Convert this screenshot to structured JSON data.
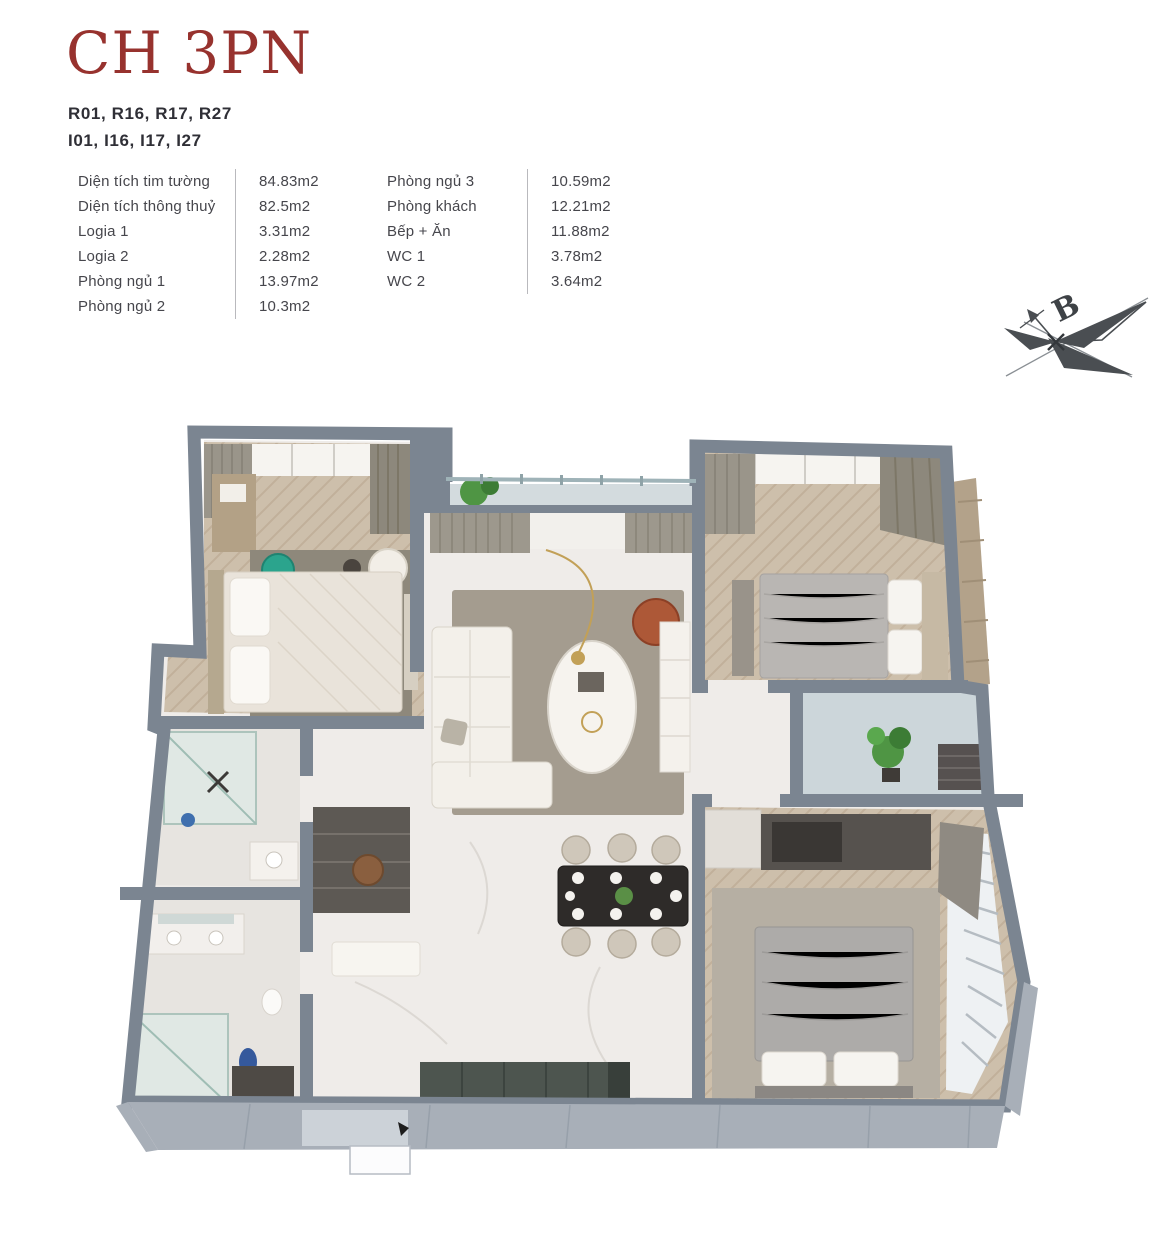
{
  "page": {
    "title": "CH 3PN"
  },
  "unit_codes": {
    "line1": "R01, R16, R17, R27",
    "line2": "I01, I16, I17, I27"
  },
  "specs": {
    "left": [
      {
        "label": "Diện tích tim tường",
        "value": "84.83m2"
      },
      {
        "label": "Diện tích thông thuỷ",
        "value": "82.5m2"
      },
      {
        "label": "Logia 1",
        "value": "3.31m2"
      },
      {
        "label": "Logia 2",
        "value": "2.28m2"
      },
      {
        "label": "Phòng ngủ 1",
        "value": "13.97m2"
      },
      {
        "label": "Phòng ngủ 2",
        "value": "10.3m2"
      }
    ],
    "right": [
      {
        "label": "Phòng ngủ 3",
        "value": "10.59m2"
      },
      {
        "label": "Phòng khách",
        "value": "12.21m2"
      },
      {
        "label": "Bếp + Ăn",
        "value": "11.88m2"
      },
      {
        "label": "WC 1",
        "value": "3.78m2"
      },
      {
        "label": "WC 2",
        "value": "3.64m2"
      }
    ]
  },
  "compass": {
    "north_label": "B"
  },
  "colors": {
    "accent_red": "#97322e",
    "text_dark": "#2f2f36",
    "wall_gray": "#7b8591",
    "wall_face": "#a8afb8",
    "wood_floor": "#cdbfab",
    "marble": "#efece9",
    "balcony_blue": "#d3dbde",
    "rug_gray": "#a49c8f",
    "teal_chair": "#2ba48d",
    "orange_chair": "#ad5837",
    "plant_green": "#4f9544"
  }
}
